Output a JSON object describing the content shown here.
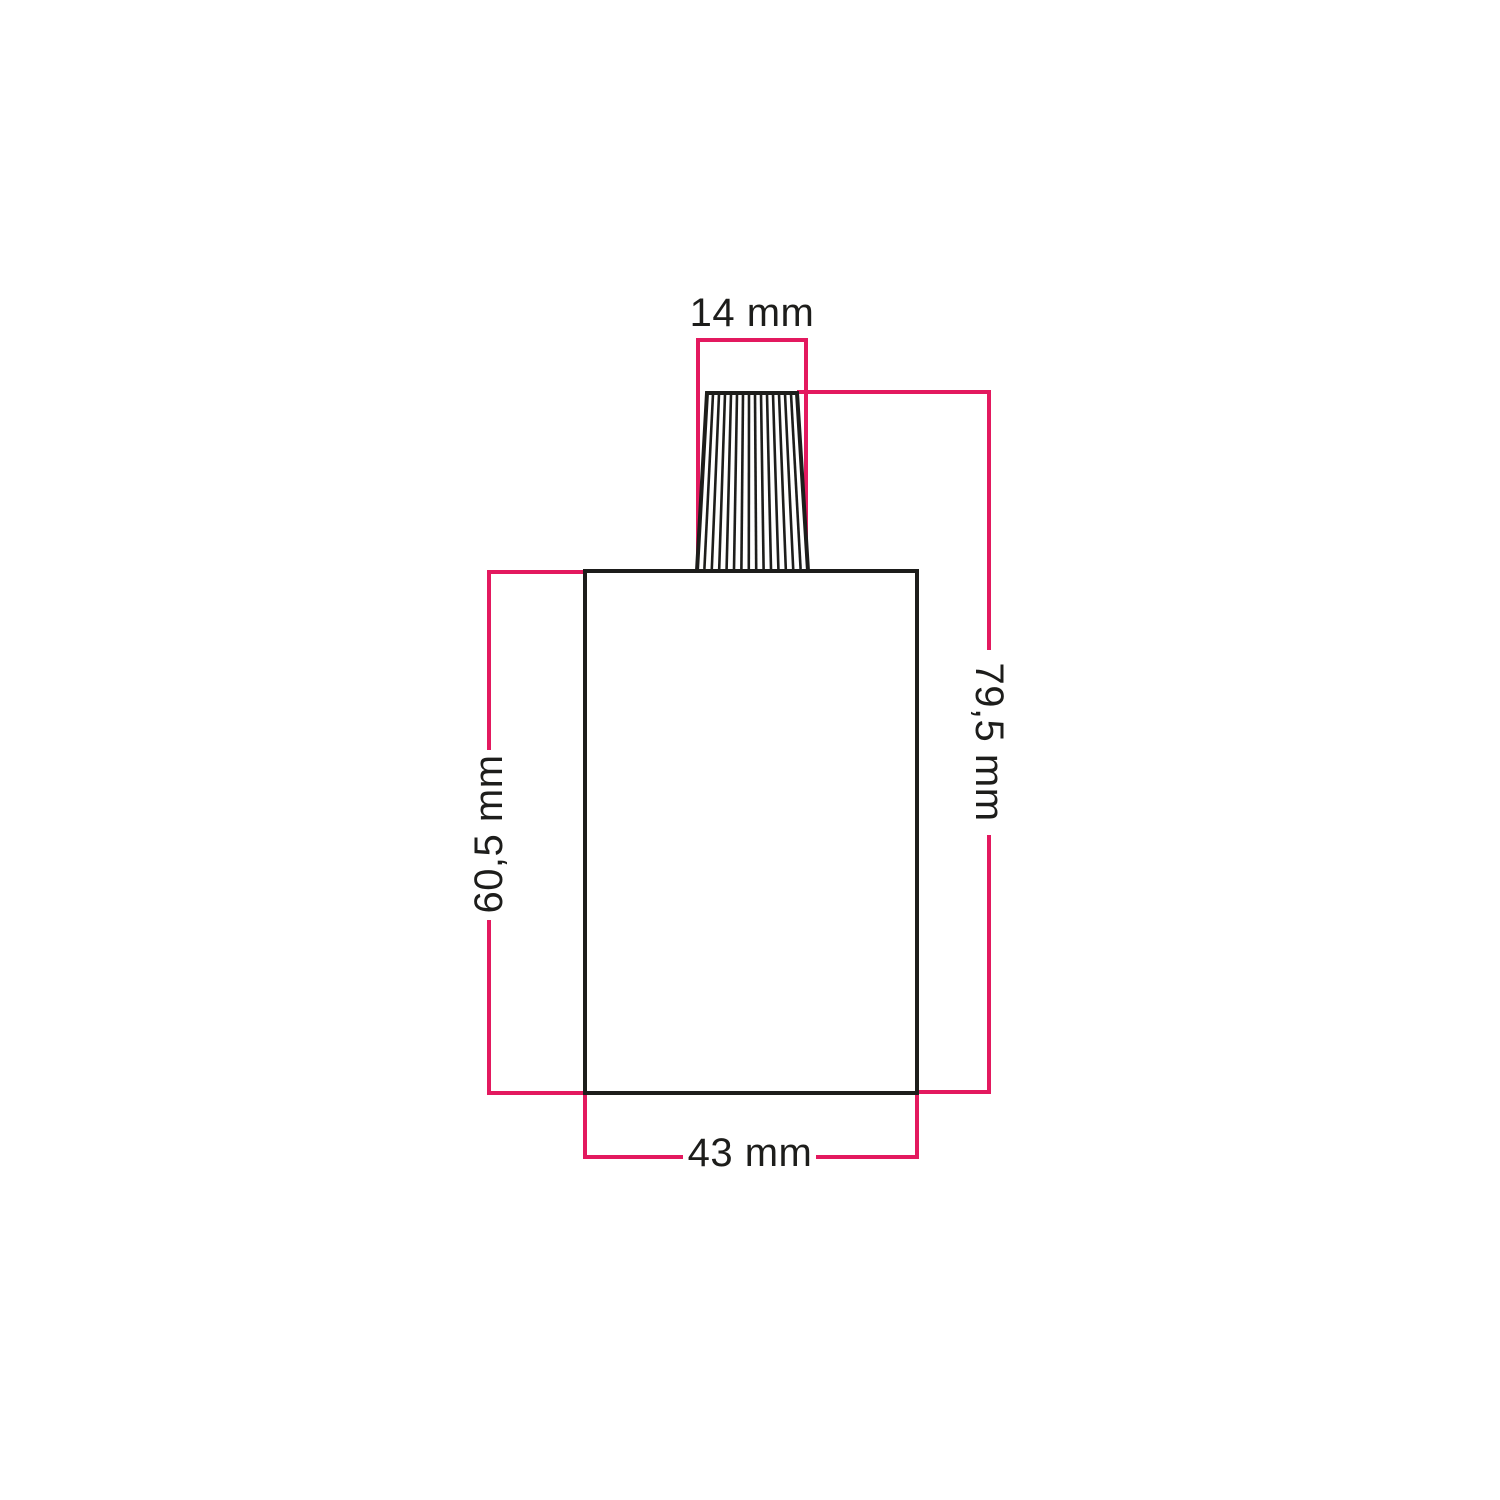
{
  "drawing": {
    "type": "technical-dimension-diagram",
    "subject": "lamp holder body with ribbed conical cable grip",
    "colors": {
      "dimension_line": "#e3195f",
      "outline": "#1d1d1b",
      "label_text": "#1d1d1b",
      "page_bg": "#ffffff"
    },
    "dimensions": {
      "cable_grip_top_width": {
        "label": "14 mm"
      },
      "overall_height": {
        "label": "79,5 mm"
      },
      "body_height": {
        "label": "60,5 mm"
      },
      "body_width": {
        "label": "43 mm"
      }
    }
  }
}
